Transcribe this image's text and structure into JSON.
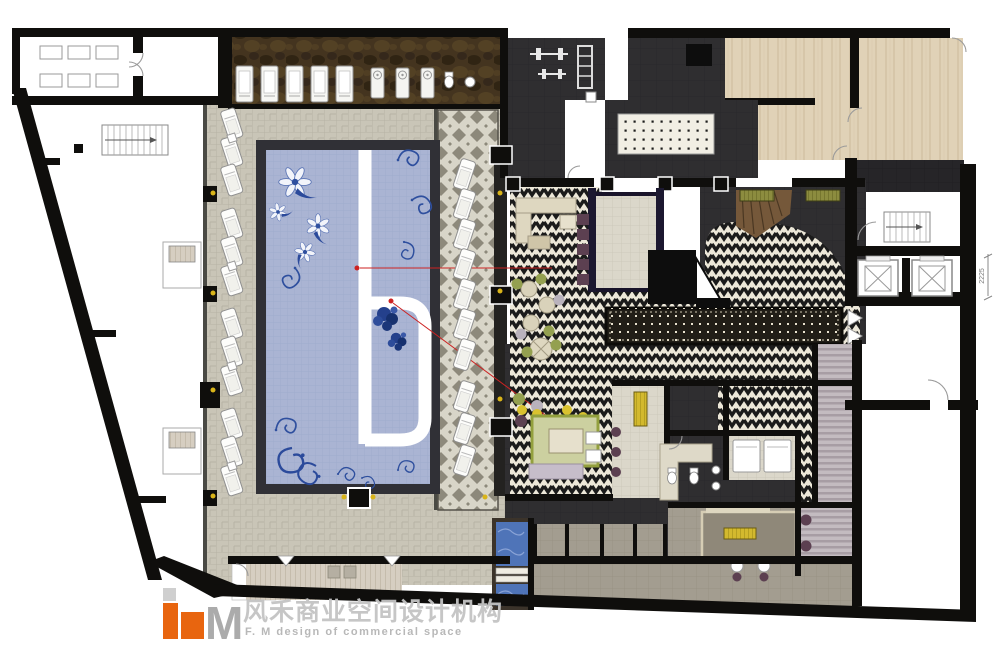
{
  "logo": {
    "letter_f": "F",
    "letter_m": "M",
    "chinese_name": "风禾商业空间设计机构",
    "english_tagline": "F. M design of commercial space"
  },
  "annotations": {
    "elevator_dimension": "2225"
  },
  "palette": {
    "wall": "#0f0e0c",
    "red": "#cc2222",
    "orange": "#e8650f",
    "purple": "#5c4051",
    "green": "#94a050",
    "lavender": "#c6bdca",
    "beige": "#ded7c0",
    "gold": "#d9c22f",
    "ydot": "#d9b419",
    "plunge": "#4f74b8",
    "runner": "#211e17",
    "logogray": "#ababab",
    "dim": "#777777",
    "woodstair": "#75583a",
    "pool_tile": "#aab4d3",
    "pool_pattern_blue": "#2e4f9e",
    "herringbone_cream": "#ece7d8",
    "herringbone_black": "#1b1b1b",
    "deck_stone": "#c9c5b7",
    "marble_brown": "#44341f",
    "charcoal": "#2f2e30",
    "wood": "#e0d2b7",
    "olive": "#8c8c3f"
  }
}
